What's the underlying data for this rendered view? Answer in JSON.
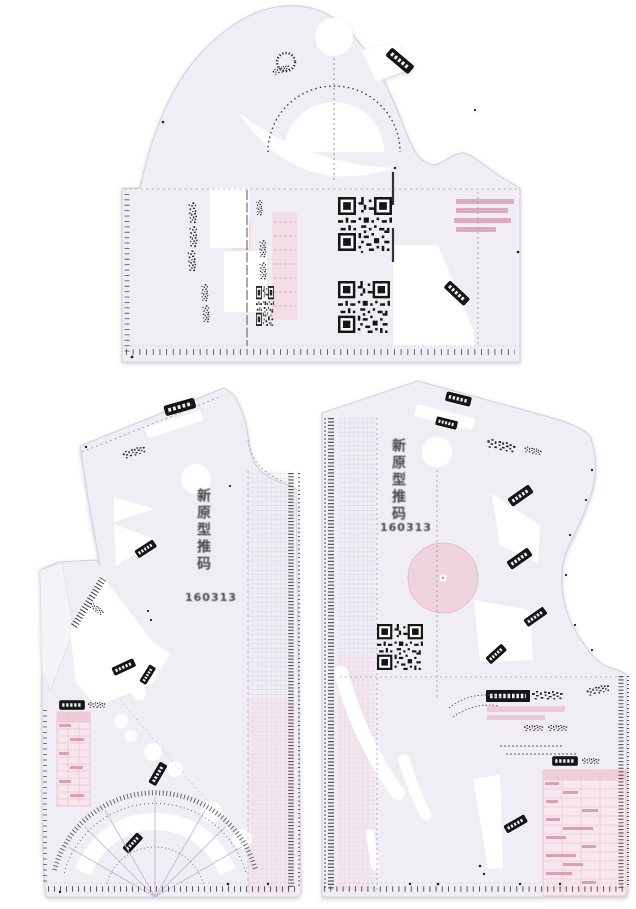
{
  "scene": {
    "type": "product-photograph",
    "subject": "Transparent plastic garment pattern-making ruler template set, 3 overlapping pieces on white background",
    "background_color": "#ffffff",
    "plastic_color": "#f0edf4",
    "edge_color": "#d6cedd",
    "print_color": "#222222",
    "pink_color": "#eac7d5",
    "deep_pink_color": "#d79ab2"
  },
  "pieces": {
    "top_template": {
      "name": "Armhole and sleeve curve template",
      "markings": [
        "qr-code",
        "qr-code",
        "protractor-arc",
        "pink-size-notes",
        "ruler-ticks"
      ]
    },
    "front_template": {
      "name": "Front bodice grading template",
      "label": "新原型推码",
      "number": "160313",
      "markings": [
        "protractor-fan",
        "button-circles",
        "size-table",
        "ruler-ticks"
      ]
    },
    "back_template": {
      "name": "Back bodice grading template",
      "label": "新原型推码",
      "number": "160313",
      "markings": [
        "qr-code",
        "pink-disc",
        "size-table",
        "curve-slots",
        "ruler-ticks"
      ]
    }
  }
}
